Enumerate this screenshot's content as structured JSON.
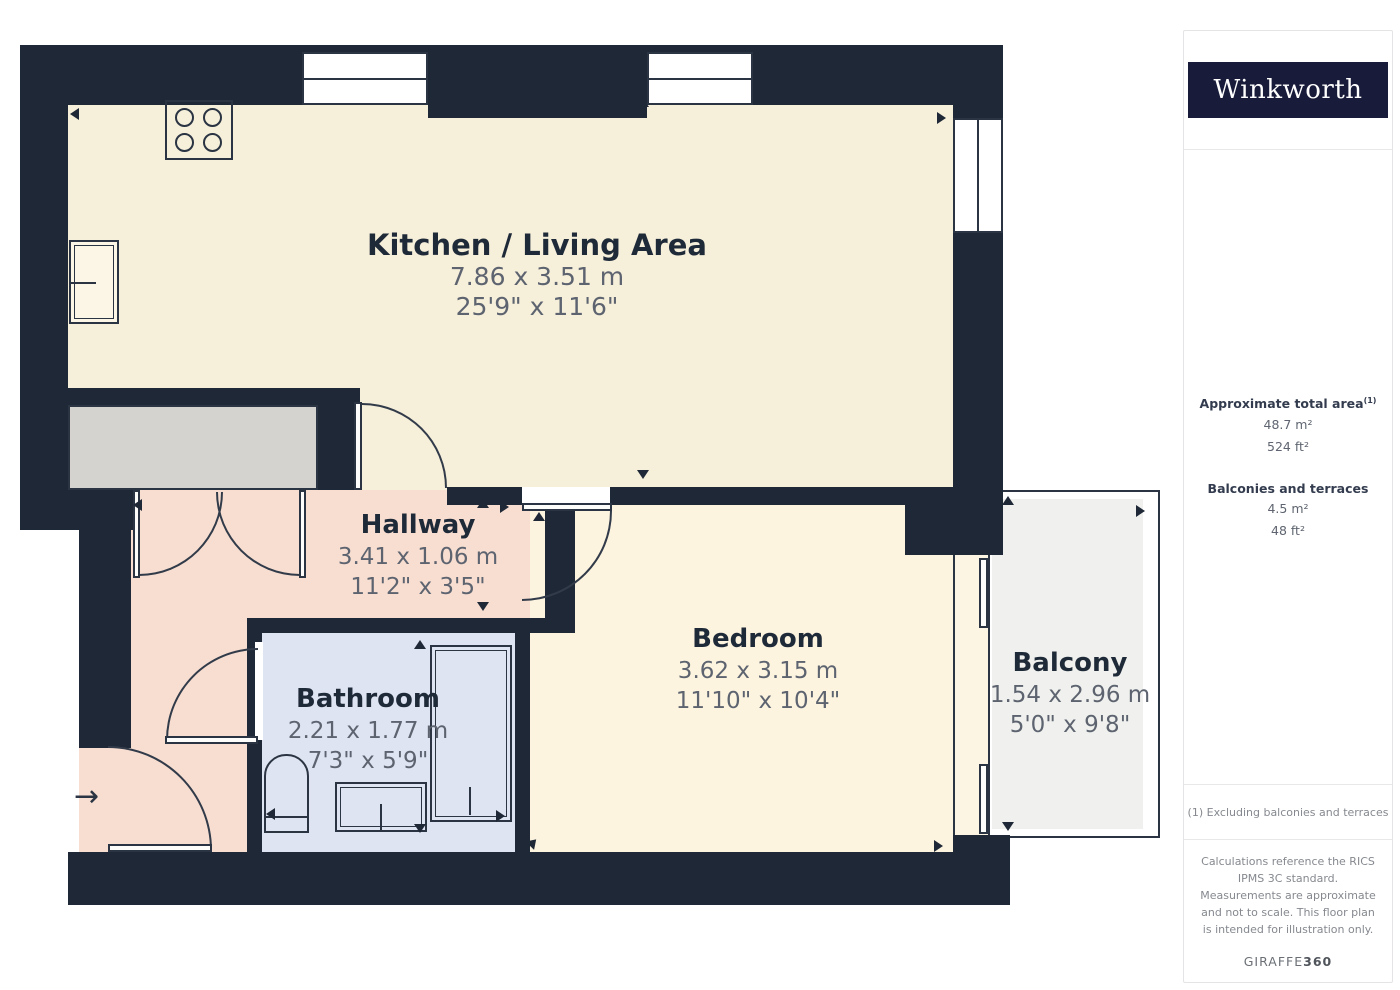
{
  "sidebar": {
    "logo_text": "Winkworth",
    "total_area": {
      "label": "Approximate total area",
      "footnote_mark": "(1)",
      "m2": "48.7 m²",
      "ft2": "524 ft²"
    },
    "balconies": {
      "label": "Balconies and terraces",
      "m2": "4.5 m²",
      "ft2": "48 ft²"
    },
    "footnote": "(1) Excluding balconies and terraces",
    "disclaimer": "Calculations reference the RICS IPMS 3C standard. Measurements are approximate and not to scale. This floor plan is intended for illustration only.",
    "brand_name": "GIRAFFE",
    "brand_suffix": "360"
  },
  "rooms": [
    {
      "id": "kitchen-living",
      "name": "Kitchen / Living Area",
      "metric": "7.86 x 3.51 m",
      "imperial": "25'9\" x 11'6\""
    },
    {
      "id": "hallway",
      "name": "Hallway",
      "metric": "3.41 x 1.06 m",
      "imperial": "11'2\" x 3'5\""
    },
    {
      "id": "bathroom",
      "name": "Bathroom",
      "metric": "2.21 x 1.77 m",
      "imperial": "7'3\" x 5'9\""
    },
    {
      "id": "bedroom",
      "name": "Bedroom",
      "metric": "3.62 x 3.15 m",
      "imperial": "11'10\" x 10'4\""
    },
    {
      "id": "balcony",
      "name": "Balcony",
      "metric": "1.54 x 2.96 m",
      "imperial": "5'0\" x 9'8\""
    }
  ],
  "colors": {
    "wall": "#1e2836",
    "kitchen_floor": "#f6efda",
    "bedroom_floor": "#fdf4e0",
    "hallway_floor": "#f8ded1",
    "bathroom_floor": "#dfe4f2",
    "balcony_floor": "#f0f1ee",
    "closet_gray": "#d4d3d0",
    "logo_navy": "#181c3a"
  }
}
